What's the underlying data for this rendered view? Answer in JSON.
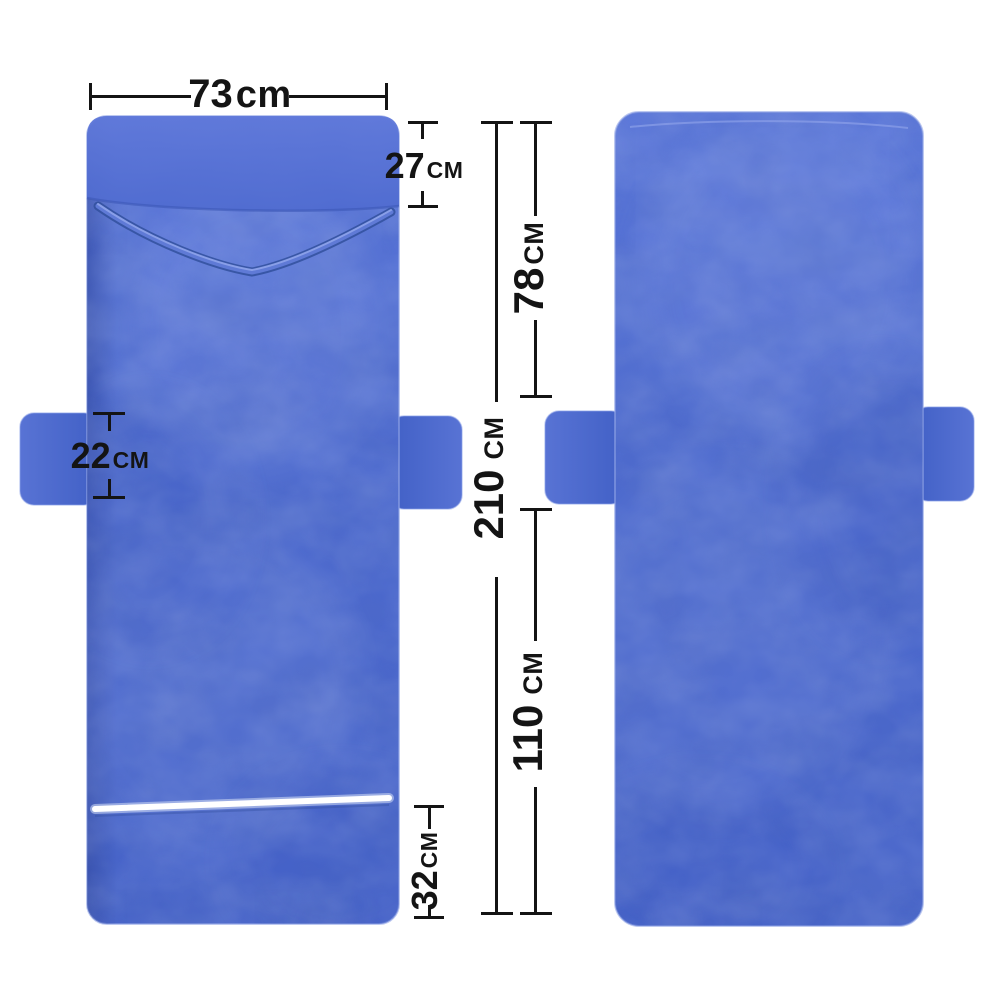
{
  "colors": {
    "background": "#ffffff",
    "annotation": "#141414",
    "fabric_base": "#4e6bd0",
    "fabric_dark": "#3c58bb",
    "fabric_light": "#7d93e3",
    "zipper_white": "#ffffff"
  },
  "dimensions": {
    "top_width": {
      "value": "73",
      "unit": "cm"
    },
    "pillow_pocket_height": {
      "value": "27",
      "unit": "CM"
    },
    "upper_section_length": {
      "value": "78",
      "unit": "CM"
    },
    "total_length": {
      "value": "210",
      "unit": "CM"
    },
    "lower_section_length": {
      "value": "110",
      "unit": "CM"
    },
    "bottom_pocket_height": {
      "value": "32",
      "unit": "CM"
    },
    "side_pocket_height": {
      "value": "22",
      "unit": "CM"
    }
  }
}
